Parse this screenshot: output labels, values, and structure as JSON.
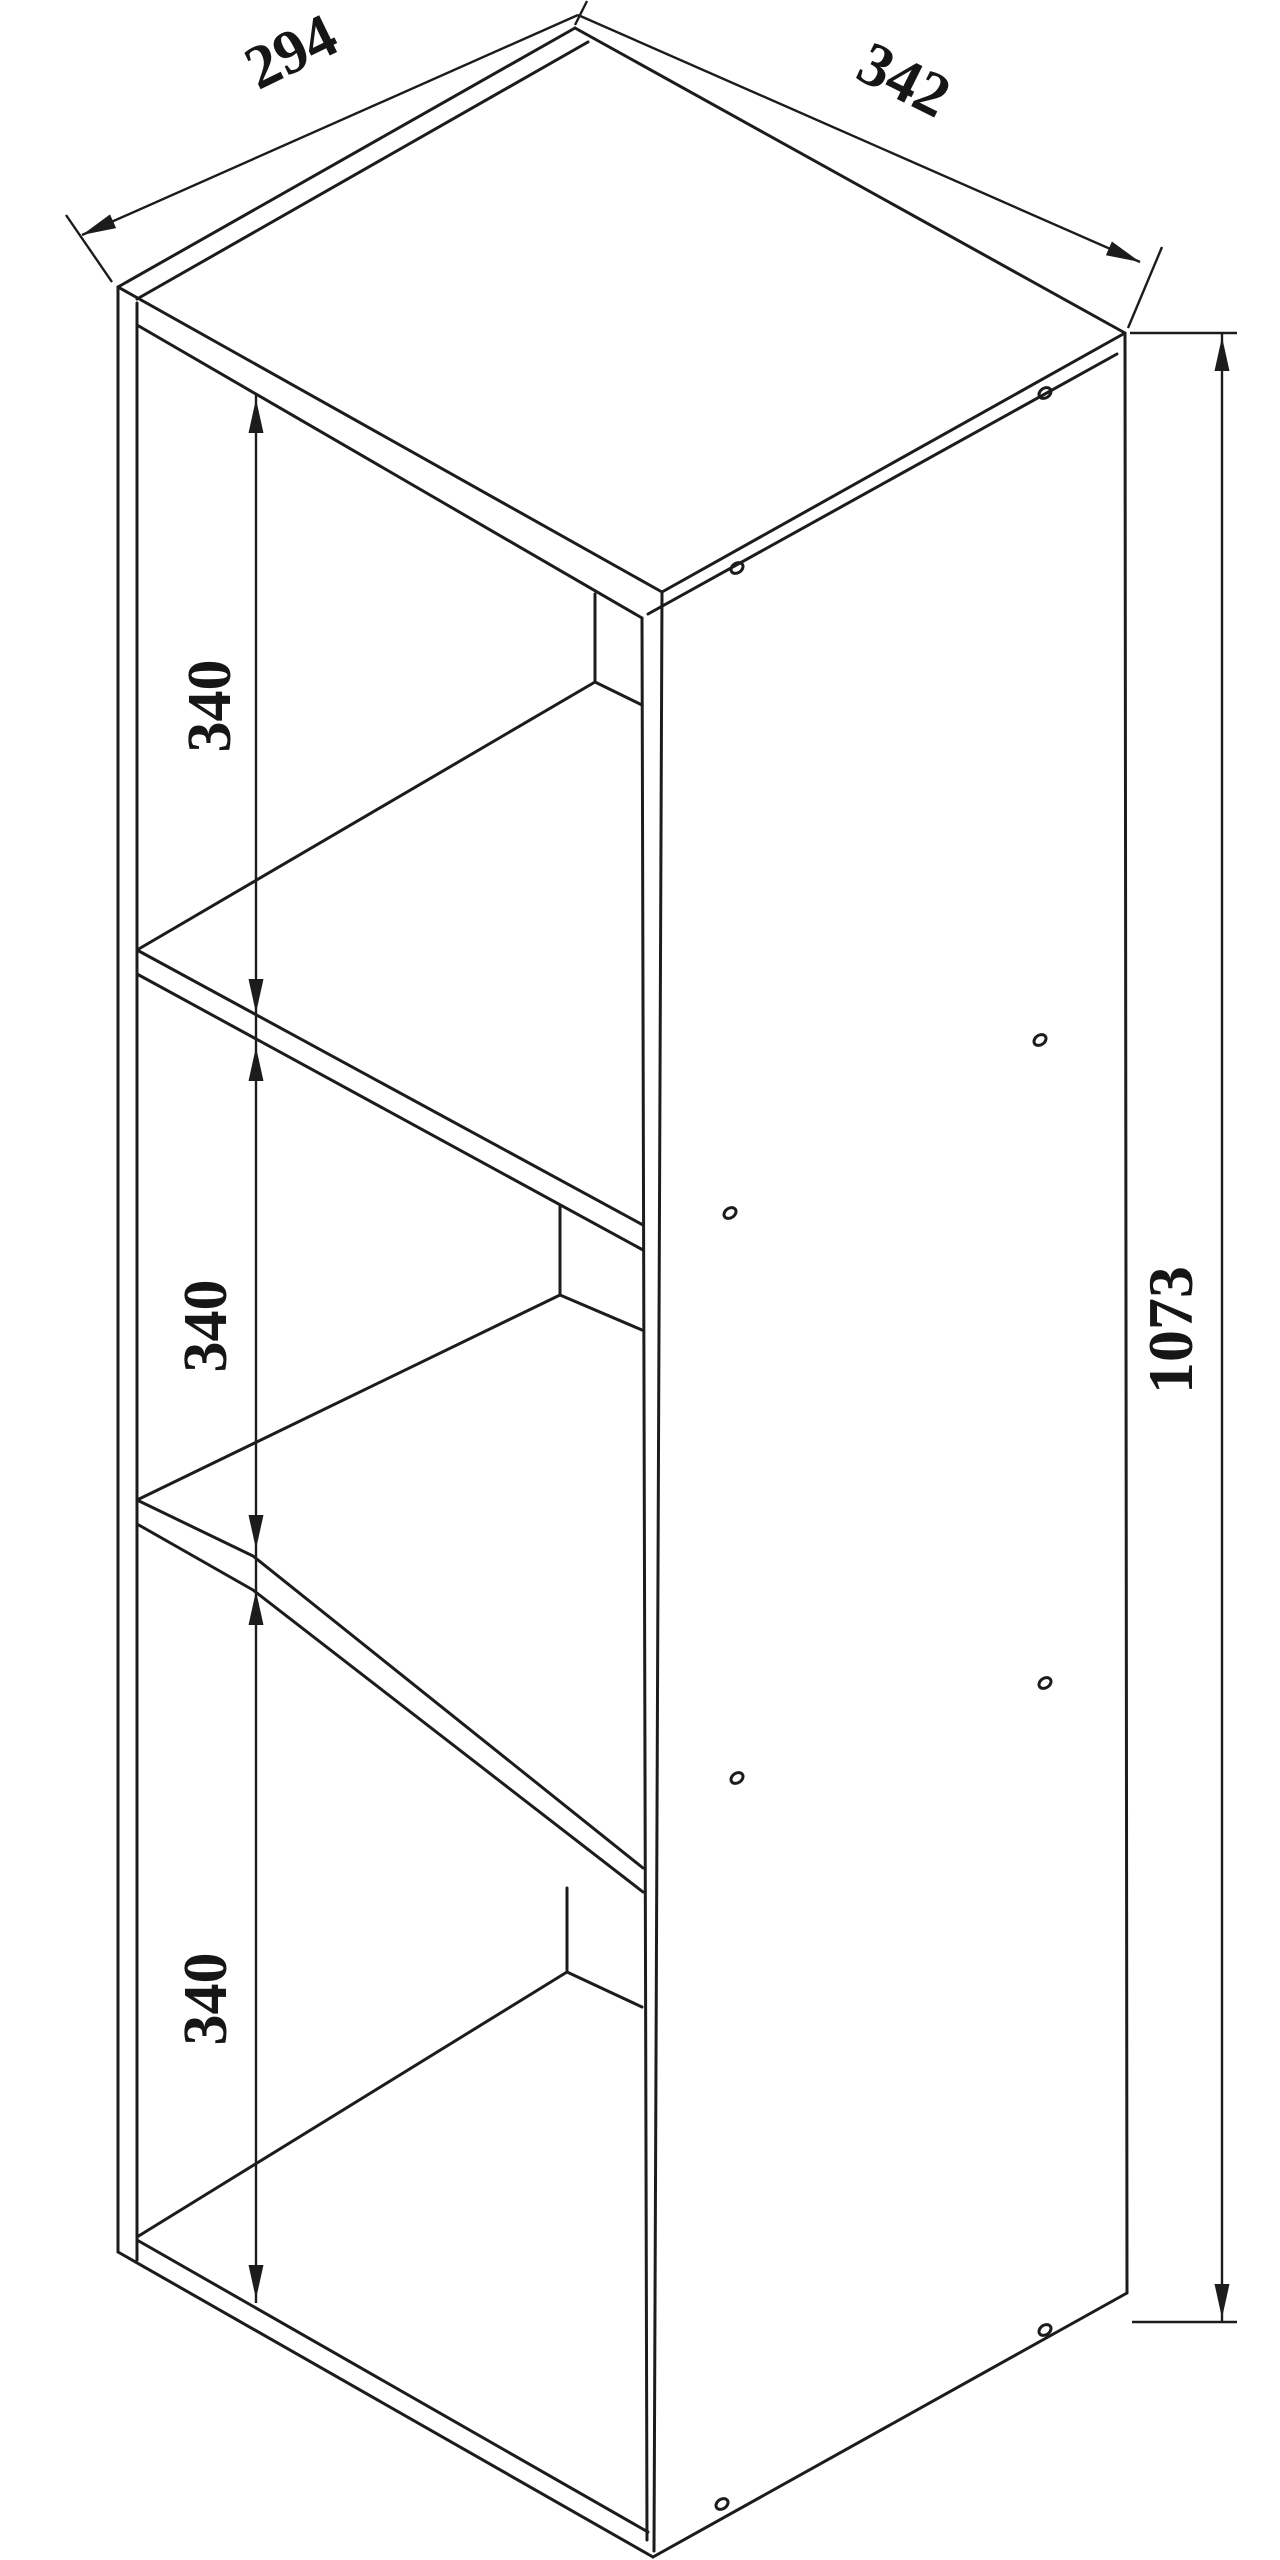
{
  "drawing": {
    "kind": "furniture dimension line drawing",
    "subject": "open shelf unit with three compartments, isometric view",
    "colors": {
      "background": "#ffffff",
      "line": "#1c1c1c",
      "text": "#161616"
    },
    "dimensions": {
      "top_depth": {
        "label": "294",
        "edge": "top-left edge of top panel"
      },
      "top_width": {
        "label": "342",
        "edge": "top-right edge of top panel"
      },
      "height": {
        "label": "1073",
        "edge": "right side panel, front-to-back height"
      },
      "compartments": [
        {
          "label": "340",
          "position": "upper compartment inner height"
        },
        {
          "label": "340",
          "position": "middle compartment inner height"
        },
        {
          "label": "340",
          "position": "lower compartment inner height"
        }
      ]
    },
    "compartment_count": 3,
    "screw_holes": {
      "front_edge_column": [
        [
          737,
          568
        ],
        [
          730,
          1213
        ],
        [
          737,
          1778
        ],
        [
          722,
          2504
        ]
      ],
      "back_edge_column": [
        [
          1045,
          393
        ],
        [
          1040,
          1040
        ],
        [
          1045,
          1683
        ],
        [
          1045,
          2330
        ]
      ]
    }
  }
}
